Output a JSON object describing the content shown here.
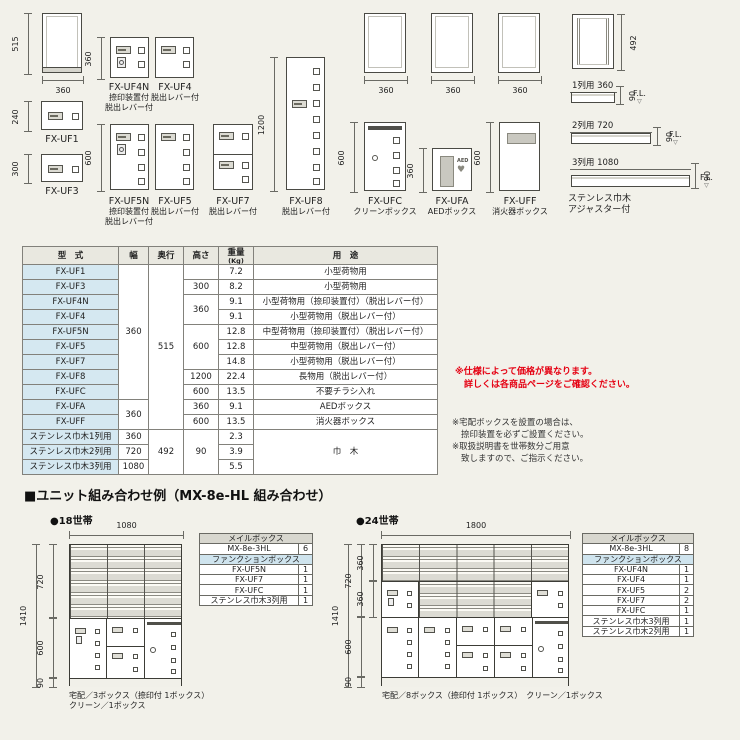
{
  "colors": {
    "background": "#f2f1ea",
    "red_note": "#e50012",
    "spec_header_bg": "#e9e8e0",
    "model_cell_bg": "#d5e8f1",
    "mail_header_bg": "#d8d7cf",
    "function_header_bg": "#cfe4ee"
  },
  "drawings": {
    "frame515": {
      "h": "515",
      "w": "360"
    },
    "uf1": {
      "name": "FX-UF1",
      "h": "240"
    },
    "uf3": {
      "name": "FX-UF3",
      "h": "300"
    },
    "uf4n": {
      "name": "FX-UF4N",
      "sub1": "捺印装置付",
      "sub2": "脱出レバー付",
      "h": "360"
    },
    "uf4": {
      "name": "FX-UF4",
      "sub1": "脱出レバー付"
    },
    "uf5n": {
      "name": "FX-UF5N",
      "sub1": "捺印装置付",
      "sub2": "脱出レバー付",
      "h": "600"
    },
    "uf5": {
      "name": "FX-UF5",
      "sub1": "脱出レバー付"
    },
    "uf7": {
      "name": "FX-UF7",
      "sub1": "脱出レバー付"
    },
    "uf8": {
      "name": "FX-UF8",
      "sub1": "脱出レバー付",
      "h": "1200"
    },
    "frames360": {
      "w": "360"
    },
    "ufc": {
      "name": "FX-UFC",
      "sub1": "クリーンボックス",
      "h": "600"
    },
    "ufa": {
      "name": "FX-UFA",
      "sub1": "AEDボックス",
      "h": "360",
      "logo": "AED",
      "heart": "♥"
    },
    "uff": {
      "name": "FX-UFF",
      "sub1": "消火器ボックス",
      "h": "600"
    },
    "skirting": {
      "frame_h": "492",
      "row1": "1列用 360",
      "row2": "2列用 720",
      "row3": "3列用 1080",
      "h90": "90",
      "fl": "F.L.",
      "fl_tri": "▽",
      "caption1": "ステンレス巾木",
      "caption2": "アジャスター付"
    }
  },
  "spec_table": {
    "h_model": "型　式",
    "h_width": "幅",
    "h_depth": "奥行",
    "h_height": "高さ",
    "h_weight": "重量",
    "h_weight_unit": "(Kg)",
    "h_use": "用　途",
    "models": [
      "FX-UF1",
      "FX-UF3",
      "FX-UF4N",
      "FX-UF4",
      "FX-UF5N",
      "FX-UF5",
      "FX-UF7",
      "FX-UF8",
      "FX-UFC",
      "FX-UFA",
      "FX-UFF",
      "ステンレス巾木1列用",
      "ステンレス巾木2列用",
      "ステンレス巾木3列用"
    ],
    "weights": [
      "7.2",
      "8.2",
      "9.1",
      "9.1",
      "12.8",
      "12.8",
      "14.8",
      "22.4",
      "13.5",
      "9.1",
      "13.5",
      "2.3",
      "3.9",
      "5.5"
    ],
    "uses": [
      "小型荷物用",
      "小型荷物用",
      "小型荷物用（捺印装置付）（脱出レバー付）",
      "小型荷物用（脱出レバー付）",
      "中型荷物用（捺印装置付）（脱出レバー付）",
      "中型荷物用（脱出レバー付）",
      "小型荷物用（脱出レバー付）",
      "長物用（脱出レバー付）",
      "不要チラシ入れ",
      "AEDボックス",
      "消火器ボックス",
      "巾　木"
    ],
    "width_a": "360",
    "width_b": "360",
    "width_1": "360",
    "width_2": "720",
    "width_3": "1080",
    "depth_a": "515",
    "depth_b": "492",
    "height_uf3": "300",
    "height_uf4": "360",
    "height_uf5": "600",
    "height_uf8": "1200",
    "height_ufc": "600",
    "height_ufa": "360",
    "height_uff": "600",
    "height_base": "90"
  },
  "notes": {
    "red1": "※仕様によって価格が異なります。",
    "red2": "詳しくは各商品ページをご確認ください。",
    "black1": "※宅配ボックスを設置の場合は、",
    "black2": "捺印装置を必ずご設置ください。",
    "black3": "※取扱説明書を世帯数分ご用意",
    "black4": "致しますので、ご指示ください。"
  },
  "combo": {
    "title": "■ユニット組み合わせ例（MX-8e-HL 組み合わせ）",
    "left": {
      "label": "●18世帯",
      "top_dim": "1080",
      "total_h": "1410",
      "mail_h": "720",
      "box_h": "600",
      "base_h": "90",
      "caption1": "宅配／3ボックス（捺印付 1ボックス）",
      "caption2": "クリーン／1ボックス",
      "table": {
        "h1": "メイルボックス",
        "rows1": [
          {
            "name": "MX-8e-3HL",
            "qty": "6"
          }
        ],
        "h2": "ファンクションボックス",
        "rows2": [
          {
            "name": "FX-UF5N",
            "qty": "1"
          },
          {
            "name": "FX-UF7",
            "qty": "1"
          },
          {
            "name": "FX-UFC",
            "qty": "1"
          },
          {
            "name": "ステンレス巾木3列用",
            "qty": "1"
          }
        ]
      }
    },
    "right": {
      "label": "●24世帯",
      "top_dim": "1800",
      "total_h": "1410",
      "mail_h": "720",
      "sub1": "360",
      "sub2": "360",
      "box_h": "600",
      "base_h": "90",
      "caption": "宅配／8ボックス（捺印付 1ボックス）　クリーン／1ボックス",
      "table": {
        "h1": "メイルボックス",
        "rows1": [
          {
            "name": "MX-8e-3HL",
            "qty": "8"
          }
        ],
        "h2": "ファンクションボックス",
        "rows2": [
          {
            "name": "FX-UF4N",
            "qty": "1"
          },
          {
            "name": "FX-UF4",
            "qty": "1"
          },
          {
            "name": "FX-UF5",
            "qty": "2"
          },
          {
            "name": "FX-UF7",
            "qty": "2"
          },
          {
            "name": "FX-UFC",
            "qty": "1"
          },
          {
            "name": "ステンレス巾木3列用",
            "qty": "1"
          },
          {
            "name": "ステンレス巾木2列用",
            "qty": "1"
          }
        ]
      }
    }
  }
}
